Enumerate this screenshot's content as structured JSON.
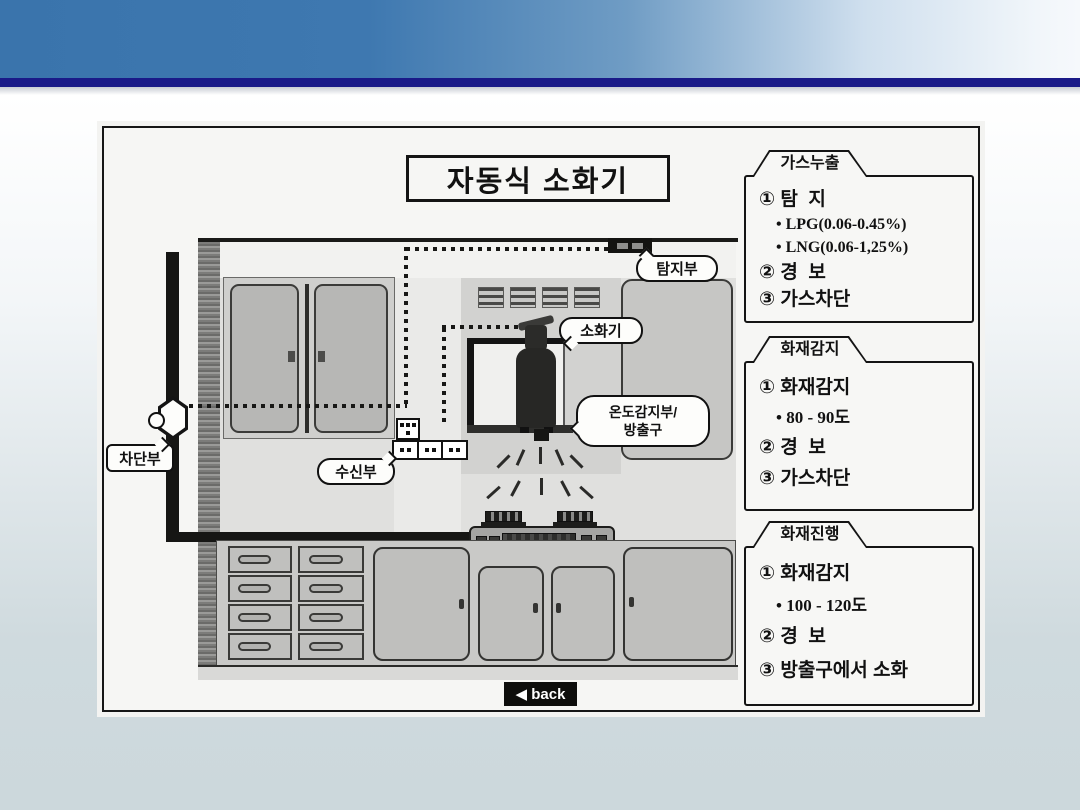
{
  "slide": {
    "title": "자동식 소화기",
    "back_label": "◀ back"
  },
  "diagram_labels": {
    "detector": "탐지부",
    "extinguisher": "소화기",
    "temp_sensor_line1": "온도감지부/",
    "temp_sensor_line2": "방출구",
    "receiver": "수신부",
    "shutoff": "차단부"
  },
  "panels": [
    {
      "tab": "가스누출",
      "lines": [
        "① 탐  지",
        "• LPG(0.06-0.45%)",
        "• LNG(0.06-1,25%)",
        "② 경  보",
        "③ 가스차단"
      ]
    },
    {
      "tab": "화재감지",
      "lines": [
        "① 화재감지",
        "• 80 - 90도",
        "② 경  보",
        "③ 가스차단"
      ]
    },
    {
      "tab": "화재진행",
      "lines": [
        "① 화재감지",
        "• 100 - 120도",
        "② 경  보",
        "③ 방출구에서 소화"
      ]
    }
  ],
  "colors": {
    "header_blue": "#3c77ae",
    "navy_line": "#1a1a88",
    "page_bottom": "#ccd8dc",
    "paper": "#f6f6f4"
  }
}
